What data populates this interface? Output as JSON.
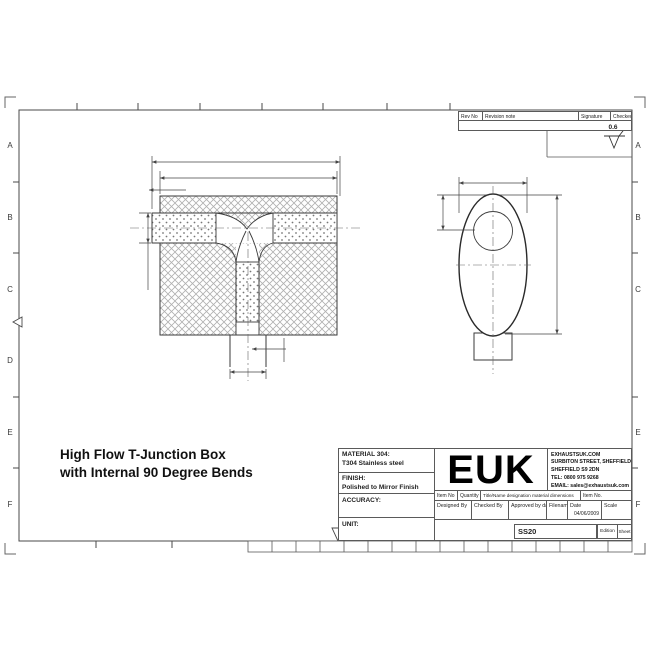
{
  "sheet": {
    "title_line1": "High Flow T-Junction Box",
    "title_line2": "with Internal 90 Degree Bends",
    "surface_finish_value": "0.6"
  },
  "zone_labels": {
    "left": [
      "A",
      "B",
      "C",
      "D",
      "E",
      "F"
    ],
    "right": [
      "A",
      "B",
      "C",
      "E",
      "F"
    ]
  },
  "revision_table": {
    "rev_no": "Rev No",
    "revision_note": "Revision note",
    "signature": "Signature",
    "checked": "Checked"
  },
  "title_block": {
    "material_label": "MATERIAL 304:",
    "material_value": "T304 Stainless steel",
    "finish_label": "FINISH:",
    "finish_value": "Polished to Mirror Finish",
    "accuracy_label": "ACCURACY:",
    "unit_label": "UNIT:",
    "logo_text": "EUK",
    "company_website": "EXHAUSTSUK.COM",
    "company_address1": "SURBITON STREET, SHEFFIELD IND EST.,",
    "company_address2": "SHEFFIELD S9 2DN",
    "company_tel": "TEL: 0800 975 9268",
    "company_email": "EMAIL: sales@exhaustsuk.com",
    "col_item_no": "Item No",
    "col_quantity": "Quantity",
    "col_title": "Title/Name designation material dimensions",
    "col_item_no2": "Item No.",
    "col_designed": "Designed By",
    "col_checked": "Checked By",
    "col_approved": "Approved by date",
    "col_filename": "Filename",
    "col_date": "Date",
    "col_scale": "Scale",
    "date_value": "04/06/2009",
    "drawing_number": "SS20",
    "edition_label": "Edition",
    "sheet_label": "Sheet"
  },
  "colors": {
    "ink": "#333333",
    "frame": "#4a4a4a",
    "hatch": "#b0b0b0",
    "background": "#ffffff"
  }
}
